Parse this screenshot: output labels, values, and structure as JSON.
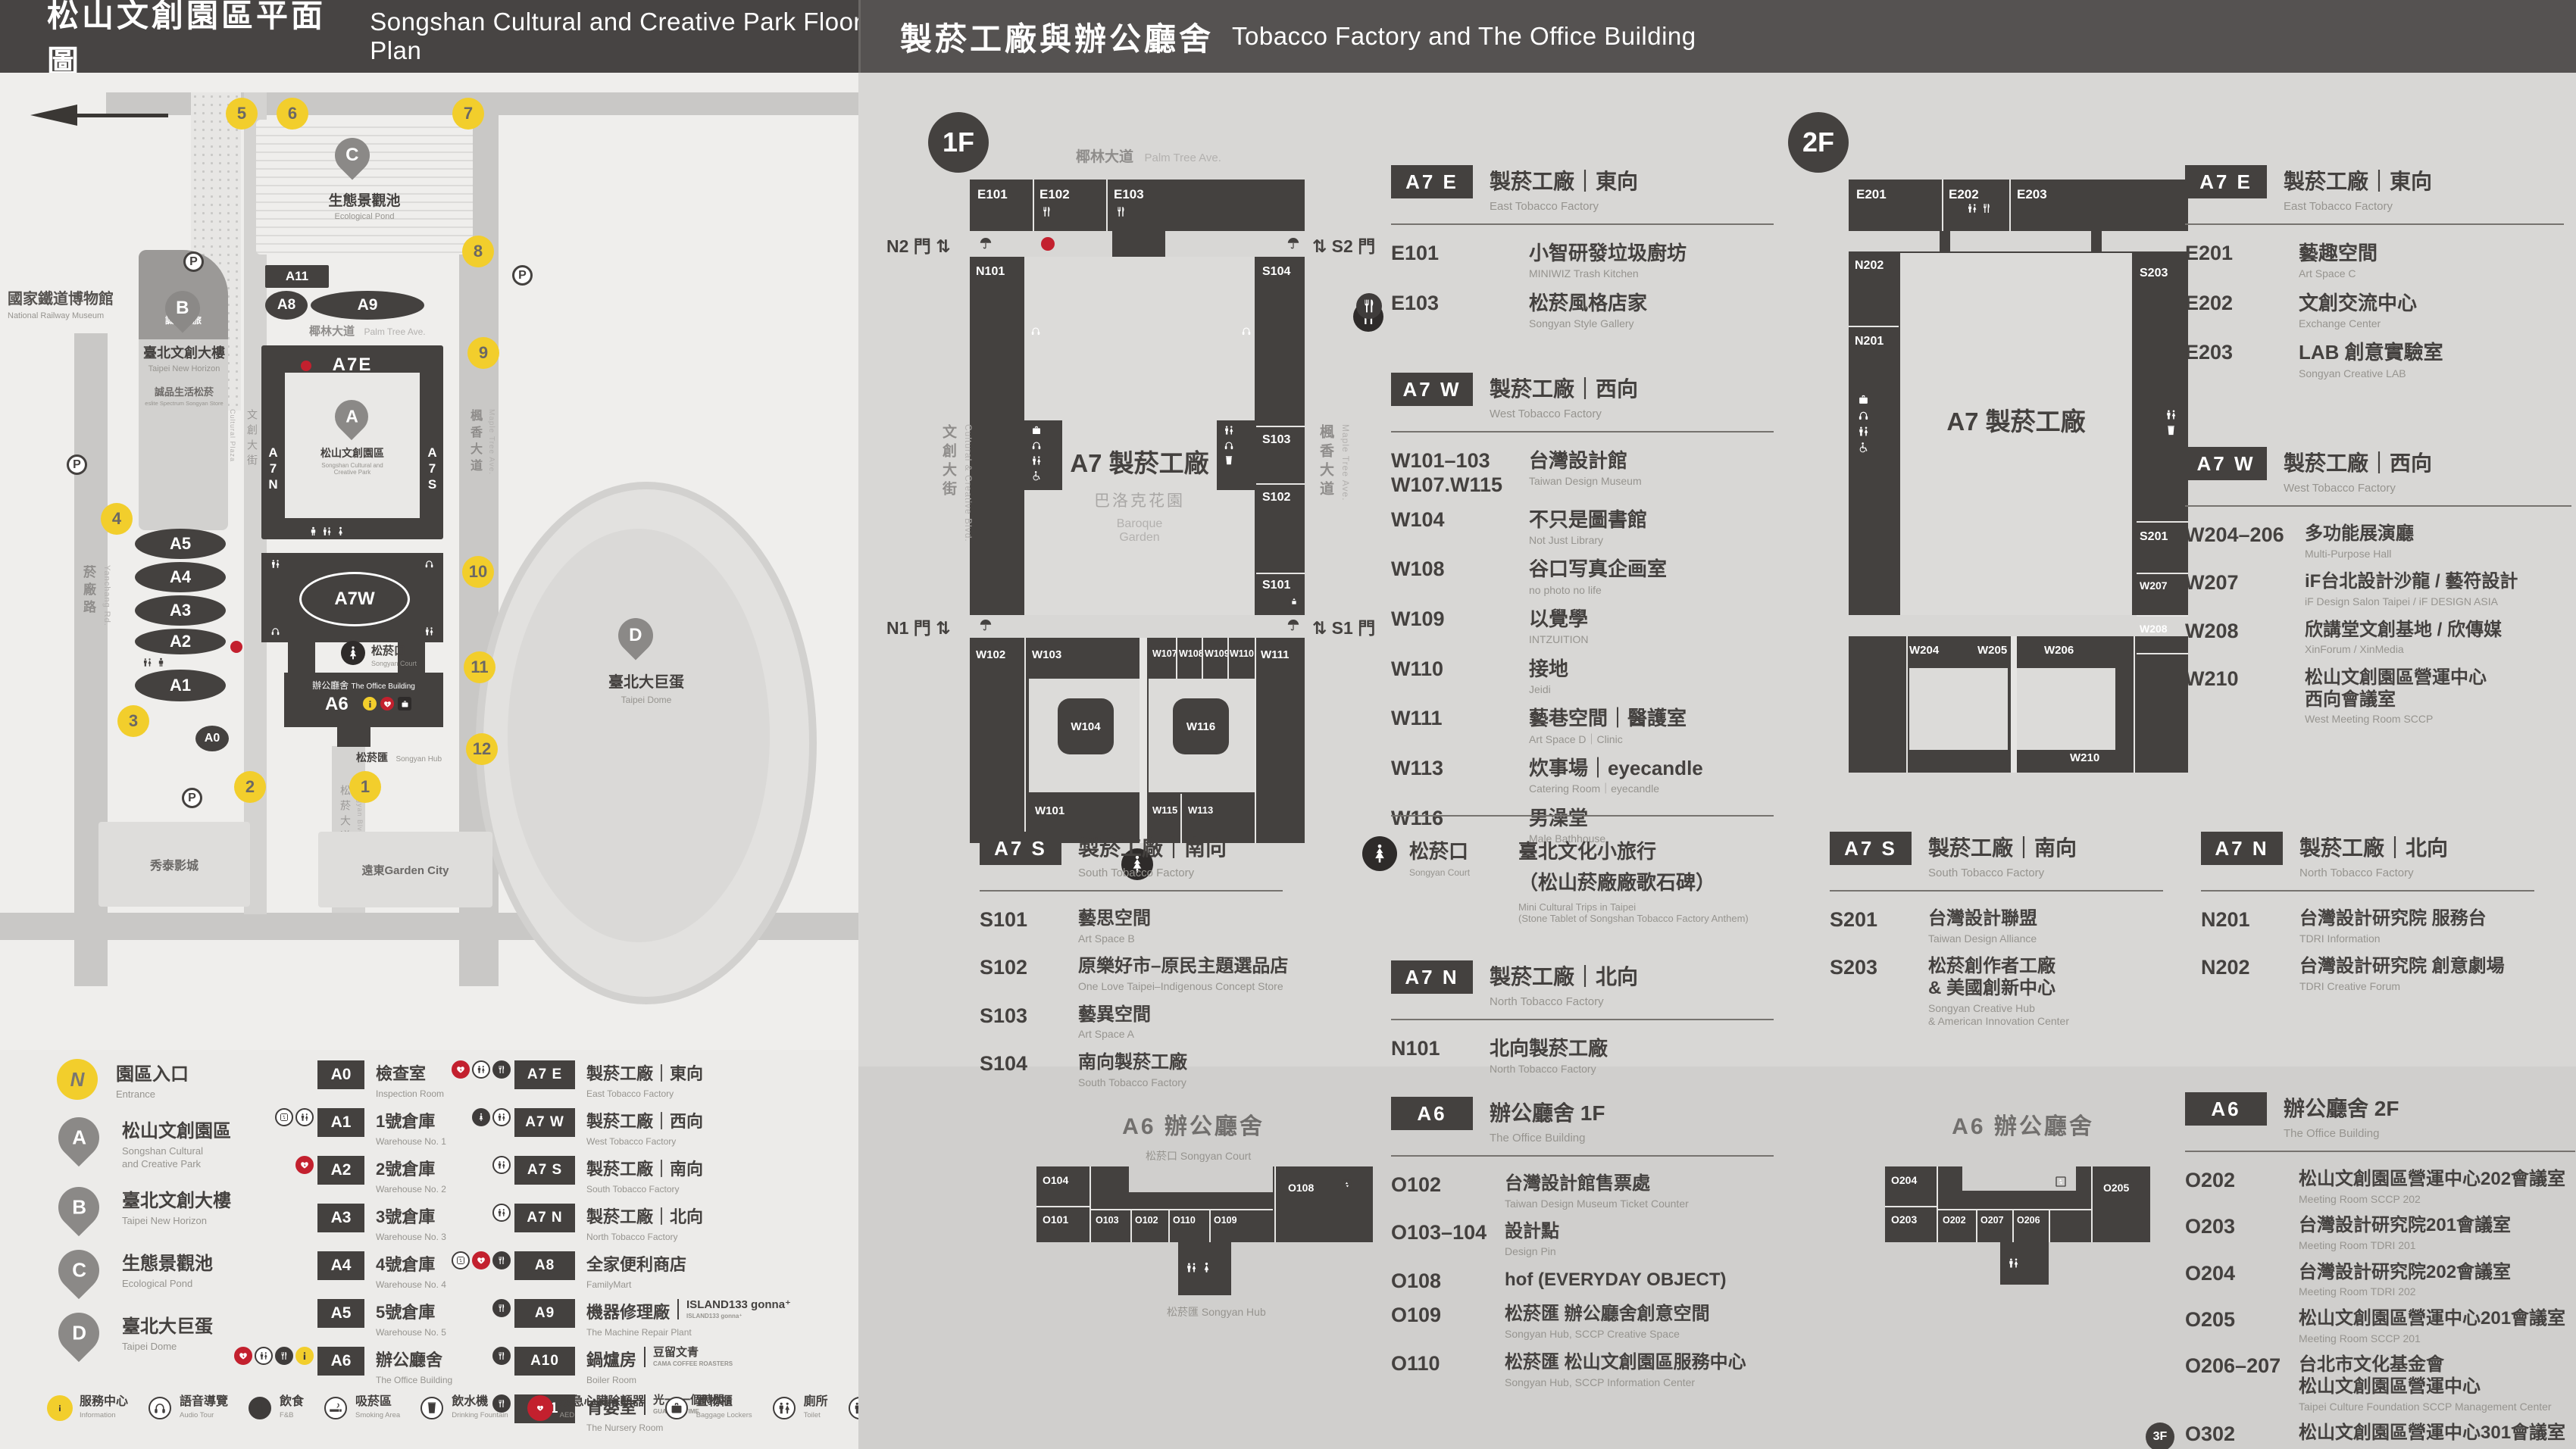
{
  "header": {
    "left_zh": "松山文創園區平面圖",
    "left_en": "Songshan Cultural and Creative Park Floor Plan",
    "right_zh": "製菸工廠與辦公廳舍",
    "right_en": "Tobacco Factory and The Office Building"
  },
  "colors": {
    "dark": "#44413f",
    "yellow": "#f2ce2c",
    "red": "#c3202e",
    "panel_left": "#ecebe9",
    "panel_right": "#d8d7d5",
    "header_left": "#474443",
    "header_right": "#555251"
  },
  "map": {
    "labels": {
      "railway_zh": "國家鐵道博物館",
      "railway_en": "National Railway Museum",
      "palm_zh": "椰林大道",
      "palm_en": "Palm Tree Ave.",
      "blvd_zh": "文創大街",
      "blvd_en": "Cultural & Creative Blvd.",
      "maple_zh": "楓香大道",
      "maple_en": "Maple Tree Ave.",
      "yanchang_zh": "菸廠路",
      "yanchang_en": "Yanchang Rd.",
      "songyan_blvd_zh": "松菸大道",
      "songyan_blvd_en": "Songyan Blvd.",
      "plaza_zh": "文化廣場",
      "plaza_en": "Cultural Plaza",
      "eslite_hotel": "誠品行旅",
      "newhorizon_zh": "臺北文創大樓",
      "newhorizon_en": "Taipei New Horizon",
      "eslite_store_zh": "誠品生活松菸",
      "eslite_store_en": "eslite Spectrum Songyan Store",
      "pond_zh": "生態景觀池",
      "pond_en": "Ecological Pond",
      "park_zh": "松山文創園區",
      "park_en1": "Songshan Cultural and",
      "park_en2": "Creative Park",
      "court_zh": "松菸口",
      "court_en": "Songyan Court",
      "office_zh": "辦公廳舍",
      "office_en": "The Office Building",
      "hub_zh": "松菸匯",
      "hub_en": "Songyan Hub",
      "dome_zh": "臺北大巨蛋",
      "dome_en": "Taipei Dome",
      "showtimes": "秀泰影城",
      "gardencity": "遠東Garden City",
      "parking": "P"
    },
    "cells": {
      "a11": "A11",
      "a8": "A8",
      "a9": "A9",
      "a7e": "A7E",
      "a7w": "A7W",
      "a7n": "A7N",
      "a7s": "A7S",
      "a6": "A6",
      "a5": "A5",
      "a4": "A4",
      "a3": "A3",
      "a2": "A2",
      "a1": "A1",
      "a0": "A0"
    },
    "gates": [
      "1",
      "2",
      "3",
      "4",
      "5",
      "6",
      "7",
      "8",
      "9",
      "10",
      "11",
      "12"
    ]
  },
  "f1": {
    "badge": "1F",
    "plan": {
      "street_zh": "椰林大道",
      "street_en": "Palm Tree Ave.",
      "left_zh": "文創大街",
      "left_en": "Cultural & Creative Blvd.",
      "right_zh": "楓香大道",
      "right_en": "Maple Tree Ave.",
      "gate_n2": "N2 門",
      "gate_s2": "S2 門",
      "gate_n1": "N1 門",
      "gate_s1": "S1 門",
      "arrows": "⇅",
      "center": "A7 製菸工廠",
      "baroque_zh": "巴洛克花園",
      "baroque_en1": "Baroque",
      "baroque_en2": "Garden",
      "cells": {
        "e101": "E101",
        "e102": "E102",
        "e103": "E103",
        "n101": "N101",
        "s104": "S104",
        "s103": "S103",
        "s102": "S102",
        "s101": "S101",
        "w102": "W102",
        "w103": "W103",
        "w107": "W107",
        "w108": "W108",
        "w109": "W109",
        "w110": "W110",
        "w111": "W111",
        "w104": "W104",
        "w116": "W116",
        "w101": "W101",
        "w115": "W115",
        "w113": "W113"
      }
    },
    "secE": {
      "code": "A7 E",
      "zh": "製菸工廠｜東向",
      "en": "East Tobacco Factory",
      "rooms": [
        {
          "id": "E101",
          "zh": "小智研發垃圾廚坊",
          "en": "MINIWIZ Trash Kitchen"
        },
        {
          "id": "E103",
          "zh": "松菸風格店家",
          "en": "Songyan Style Gallery",
          "pre_icon": "fork"
        }
      ]
    },
    "secW": {
      "code": "A7 W",
      "zh": "製菸工廠｜西向",
      "en": "West Tobacco Factory",
      "rooms": [
        {
          "id": "W101–103",
          "id2": "W107.W115",
          "zh": "台灣設計館",
          "en": "Taiwan Design Museum"
        },
        {
          "id": "W104",
          "zh": "不只是圖書館",
          "en": "Not Just Library"
        },
        {
          "id": "W108",
          "zh": "谷口写真企画室",
          "en": "no photo no life"
        },
        {
          "id": "W109",
          "zh": "以覺學",
          "en": "INTZUITION"
        },
        {
          "id": "W110",
          "zh": "接地",
          "en": "Jeidi"
        },
        {
          "id": "W111",
          "zh": "藝巷空間｜醫護室",
          "en": "Art Space D｜Clinic"
        },
        {
          "id": "W113",
          "zh": "炊事場｜eyecandle",
          "en": "Catering Room｜eyecandle"
        },
        {
          "id": "W116",
          "zh": "男澡堂",
          "en": "Male Bathhouse"
        }
      ]
    },
    "secS": {
      "code": "A7 S",
      "zh": "製菸工廠｜南向",
      "en": "South Tobacco Factory",
      "rooms": [
        {
          "id": "S101",
          "zh": "藝思空間",
          "en": "Art Space B"
        },
        {
          "id": "S102",
          "zh": "原樂好市–原民主題選品店",
          "en": "One Love Taipei–Indigenous Concept Store"
        },
        {
          "id": "S103",
          "zh": "藝異空間",
          "en": "Art Space A"
        },
        {
          "id": "S104",
          "zh": "南向製菸工廠",
          "en": "South Tobacco Factory"
        }
      ]
    },
    "court": {
      "zh": "松菸口",
      "en": "Songyan Court",
      "t_zh": "臺北文化小旅行",
      "t_zh2": "（松山菸廠廠歌石碑）",
      "t_en": "Mini Cultural Trips in Taipei",
      "t_en2": "(Stone Tablet of Songshan Tobacco Factory Anthem)"
    },
    "secN": {
      "code": "A7 N",
      "zh": "製菸工廠｜北向",
      "en": "North Tobacco Factory",
      "rooms": [
        {
          "id": "N101",
          "zh": "北向製菸工廠",
          "en": "North Tobacco Factory"
        }
      ]
    }
  },
  "f2": {
    "badge": "2F",
    "plan": {
      "center": "A7 製菸工廠",
      "cells": {
        "e201": "E201",
        "e202": "E202",
        "e203": "E203",
        "n202": "N202",
        "n201": "N201",
        "s203": "S203",
        "s201": "S201",
        "w204": "W204",
        "w205": "W205",
        "w206": "W206",
        "w207": "W207",
        "w208": "W208",
        "w210": "W210"
      }
    },
    "secE": {
      "code": "A7 E",
      "zh": "製菸工廠｜東向",
      "en": "East Tobacco Factory",
      "rooms": [
        {
          "id": "E201",
          "zh": "藝趣空間",
          "en": "Art Space C"
        },
        {
          "id": "E202",
          "zh": "文創交流中心",
          "en": "Exchange Center"
        },
        {
          "id": "E203",
          "zh": "LAB 創意實驗室",
          "en": "Songyan Creative LAB"
        }
      ]
    },
    "secW": {
      "code": "A7 W",
      "zh": "製菸工廠｜西向",
      "en": "West Tobacco Factory",
      "rooms": [
        {
          "id": "W204–206",
          "zh": "多功能展演廳",
          "en": "Multi-Purpose Hall"
        },
        {
          "id": "W207",
          "zh": "iF台北設計沙龍 / 藝符設計",
          "en": "iF Design Salon Taipei / iF DESIGN ASIA"
        },
        {
          "id": "W208",
          "zh": "欣講堂文創基地 / 欣傳媒",
          "en": "XinForum / XinMedia"
        },
        {
          "id": "W210",
          "zh": "松山文創園區營運中心",
          "zh2": "西向會議室",
          "en": "West Meeting Room SCCP"
        }
      ]
    },
    "secS": {
      "code": "A7 S",
      "zh": "製菸工廠｜南向",
      "en": "South Tobacco Factory",
      "rooms": [
        {
          "id": "S201",
          "zh": "台灣設計聯盟",
          "en": "Taiwan Design Alliance"
        },
        {
          "id": "S203",
          "zh": "松菸創作者工廠",
          "zh2": "& 美國創新中心",
          "en": "Songyan Creative Hub",
          "en2": "& American Innovation Center"
        }
      ]
    },
    "secN": {
      "code": "A7 N",
      "zh": "製菸工廠｜北向",
      "en": "North Tobacco Factory",
      "rooms": [
        {
          "id": "N201",
          "zh": "台灣設計研究院 服務台",
          "en": "TDRI Information"
        },
        {
          "id": "N202",
          "zh": "台灣設計研究院 創意劇場",
          "en": "TDRI Creative Forum"
        }
      ]
    }
  },
  "a6f1": {
    "code": "A6",
    "t_zh": "辦公廳舍 1F",
    "t_en": "The Office Building",
    "plan_title": "A6 辦公廳舍",
    "court_lab": "松菸口 Songyan Court",
    "hub_lab": "松菸匯 Songyan Hub",
    "cells": {
      "o104": "O104",
      "o101": "O101",
      "o103": "O103",
      "o102": "O102",
      "o110": "O110",
      "o109": "O109",
      "o108": "O108"
    },
    "rooms": [
      {
        "id": "O102",
        "zh": "台灣設計館售票處",
        "en": "Taiwan Design Museum Ticket Counter"
      },
      {
        "id": "O103–104",
        "zh": "設計點",
        "en": "Design Pin"
      },
      {
        "id": "O108",
        "zh": "hof (EVERYDAY OBJECT)"
      },
      {
        "id": "O109",
        "zh": "松菸匯 辦公廳舍創意空間",
        "en": "Songyan Hub, SCCP Creative Space"
      },
      {
        "id": "O110",
        "zh": "松菸匯 松山文創園區服務中心",
        "en": "Songyan Hub, SCCP Information Center"
      }
    ]
  },
  "a6f2": {
    "code": "A6",
    "t_zh": "辦公廳舍 2F",
    "t_en": "The Office Building",
    "plan_title": "A6 辦公廳舍",
    "cells": {
      "o204": "O204",
      "o203": "O203",
      "o202": "O202",
      "o207": "O207",
      "o206": "O206",
      "o205": "O205"
    },
    "rooms": [
      {
        "id": "O202",
        "zh": "松山文創園區營運中心202會議室",
        "en": "Meeting Room SCCP 202"
      },
      {
        "id": "O203",
        "zh": "台灣設計研究院201會議室",
        "en": "Meeting Room TDRI 201"
      },
      {
        "id": "O204",
        "zh": "台灣設計研究院202會議室",
        "en": "Meeting Room TDRI 202"
      },
      {
        "id": "O205",
        "zh": "松山文創園區營運中心201會議室",
        "en": "Meeting Room SCCP 201"
      },
      {
        "id": "O206–207",
        "zh": "台北市文化基金會",
        "zh2": "松山文創園區營運中心",
        "en": "Taipei Culture Foundation SCCP Management Center"
      },
      {
        "id": "O302",
        "zh": "松山文創園區營運中心301會議室",
        "en": "Meeting Room SCCP 301",
        "pre_badge": "3F"
      }
    ]
  },
  "legend": {
    "pins": [
      {
        "mark": "N",
        "type": "circle",
        "zh": "園區入口",
        "en": "Entrance"
      },
      {
        "mark": "A",
        "type": "pin",
        "zh": "松山文創園區",
        "en": "Songshan Cultural",
        "en2": "and Creative Park"
      },
      {
        "mark": "B",
        "type": "pin",
        "zh": "臺北文創大樓",
        "en": "Taipei New Horizon"
      },
      {
        "mark": "C",
        "type": "pin",
        "zh": "生態景觀池",
        "en": "Ecological Pond"
      },
      {
        "mark": "D",
        "type": "pin",
        "zh": "臺北大巨蛋",
        "en": "Taipei Dome"
      }
    ],
    "groupA": [
      {
        "code": "A0",
        "zh": "檢查室",
        "en": "Inspection Room",
        "icons": []
      },
      {
        "code": "A1",
        "zh": "1號倉庫",
        "en": "Warehouse No. 1",
        "icons": [
          "lift",
          "pair"
        ]
      },
      {
        "code": "A2",
        "zh": "2號倉庫",
        "en": "Warehouse No. 2",
        "icons": [
          "aed"
        ]
      },
      {
        "code": "A3",
        "zh": "3號倉庫",
        "en": "Warehouse No. 3",
        "icons": []
      },
      {
        "code": "A4",
        "zh": "4號倉庫",
        "en": "Warehouse No. 4",
        "icons": []
      },
      {
        "code": "A5",
        "zh": "5號倉庫",
        "en": "Warehouse No. 5",
        "icons": []
      },
      {
        "code": "A6",
        "zh": "辦公廳舍",
        "en": "The Office Building",
        "icons": [
          "aed",
          "pair",
          "fork",
          "info"
        ]
      }
    ],
    "groupB": [
      {
        "code": "A7 E",
        "zh": "製菸工廠｜東向",
        "en": "East Tobacco Factory",
        "icons": [
          "aed",
          "pair",
          "fork"
        ]
      },
      {
        "code": "A7 W",
        "zh": "製菸工廠｜西向",
        "en": "West Tobacco Factory",
        "icons": [
          "tree",
          "pair"
        ]
      },
      {
        "code": "A7 S",
        "zh": "製菸工廠｜南向",
        "en": "South Tobacco Factory",
        "icons": [
          "pair"
        ]
      },
      {
        "code": "A7 N",
        "zh": "製菸工廠｜北向",
        "en": "North Tobacco Factory",
        "icons": [
          "pair"
        ]
      },
      {
        "code": "A8",
        "zh": "全家便利商店",
        "en": "FamilyMart",
        "icons": [
          "lift",
          "aed",
          "fork"
        ]
      },
      {
        "code": "A9",
        "zh": "機器修理廠",
        "brand": "ISLAND133 gonna⁺",
        "brand_sub": "ISLAND133 gonna⁺",
        "en": "The Machine Repair Plant",
        "icons": [
          "fork"
        ]
      },
      {
        "code": "A10",
        "zh": "鍋爐房",
        "brand": "豆留文青",
        "brand_sub": "CAMA COFFEE ROASTERS",
        "en": "Boiler Room",
        "icons": [
          "fork"
        ]
      },
      {
        "code": "A11",
        "zh": "育嬰室",
        "brand": "光一 一個時間",
        "brand_sub": "GUANG YI TIME",
        "en": "The Nursery Room",
        "icons": [
          "fork"
        ]
      }
    ]
  },
  "facilities": [
    {
      "icon": "info",
      "style": "yellow",
      "zh": "服務中心",
      "en": "Information"
    },
    {
      "icon": "audio",
      "style": "plain",
      "zh": "語音導覽",
      "en": "Audio Tour"
    },
    {
      "icon": "fork",
      "style": "plain",
      "zh": "飲食",
      "en": "F&B"
    },
    {
      "icon": "smoke",
      "style": "plain",
      "zh": "吸菸區",
      "en": "Smoking Area"
    },
    {
      "icon": "cup",
      "style": "plain",
      "zh": "飲水機",
      "en": "Drinking Fountain"
    },
    {
      "icon": "aed",
      "style": "red",
      "zh": "緊急心臟除顫器",
      "en": "AED"
    },
    {
      "icon": "case",
      "style": "plain",
      "zh": "置物櫃",
      "en": "Baggage Lockers"
    },
    {
      "icon": "pair",
      "style": "plain",
      "zh": "廁所",
      "en": "Toilet"
    },
    {
      "icon": "pair",
      "style": "plain",
      "zh": "性別友善廁所",
      "en": "All Gender Toilet"
    },
    {
      "icon": "male",
      "style": "plain",
      "zh": "男廁",
      "en": "Men's Toilet"
    },
    {
      "icon": "female",
      "style": "plain",
      "zh": "女廁",
      "en": "Women's Toilet"
    },
    {
      "icon": "wheel",
      "style": "plain",
      "zh": "無障礙廁所",
      "en": "Accessible Toilet"
    },
    {
      "icon": "nursing",
      "style": "dark",
      "zh": "哺集乳室",
      "en": "Breastfeeding Room"
    },
    {
      "icon": "battery",
      "style": "plain",
      "zh": "共享行動電源",
      "en": "Power Bank Rental"
    },
    {
      "icon": "umbrella",
      "style": "plain",
      "zh": "共享傘",
      "en": "Umbrella Rental"
    },
    {
      "icon": "stairs",
      "style": "plain",
      "zh": "階梯",
      "en": "Stairs"
    },
    {
      "icon": "goods",
      "style": "plain",
      "zh": "貨梯",
      "en": "Elevator For Goods"
    },
    {
      "icon": "lift",
      "style": "plain",
      "zh": "無障礙電梯",
      "en": "Accessible Elevator"
    },
    {
      "icon": "tree",
      "style": "dark",
      "zh": "臺北文化小旅行",
      "zh_small": "(松山菸廠廠歌石碑)",
      "en": "Mini Cultural Trips in Taipei",
      "en2": "(Stone Tablet of Songshan Tobacco Factory Anthem)"
    }
  ]
}
